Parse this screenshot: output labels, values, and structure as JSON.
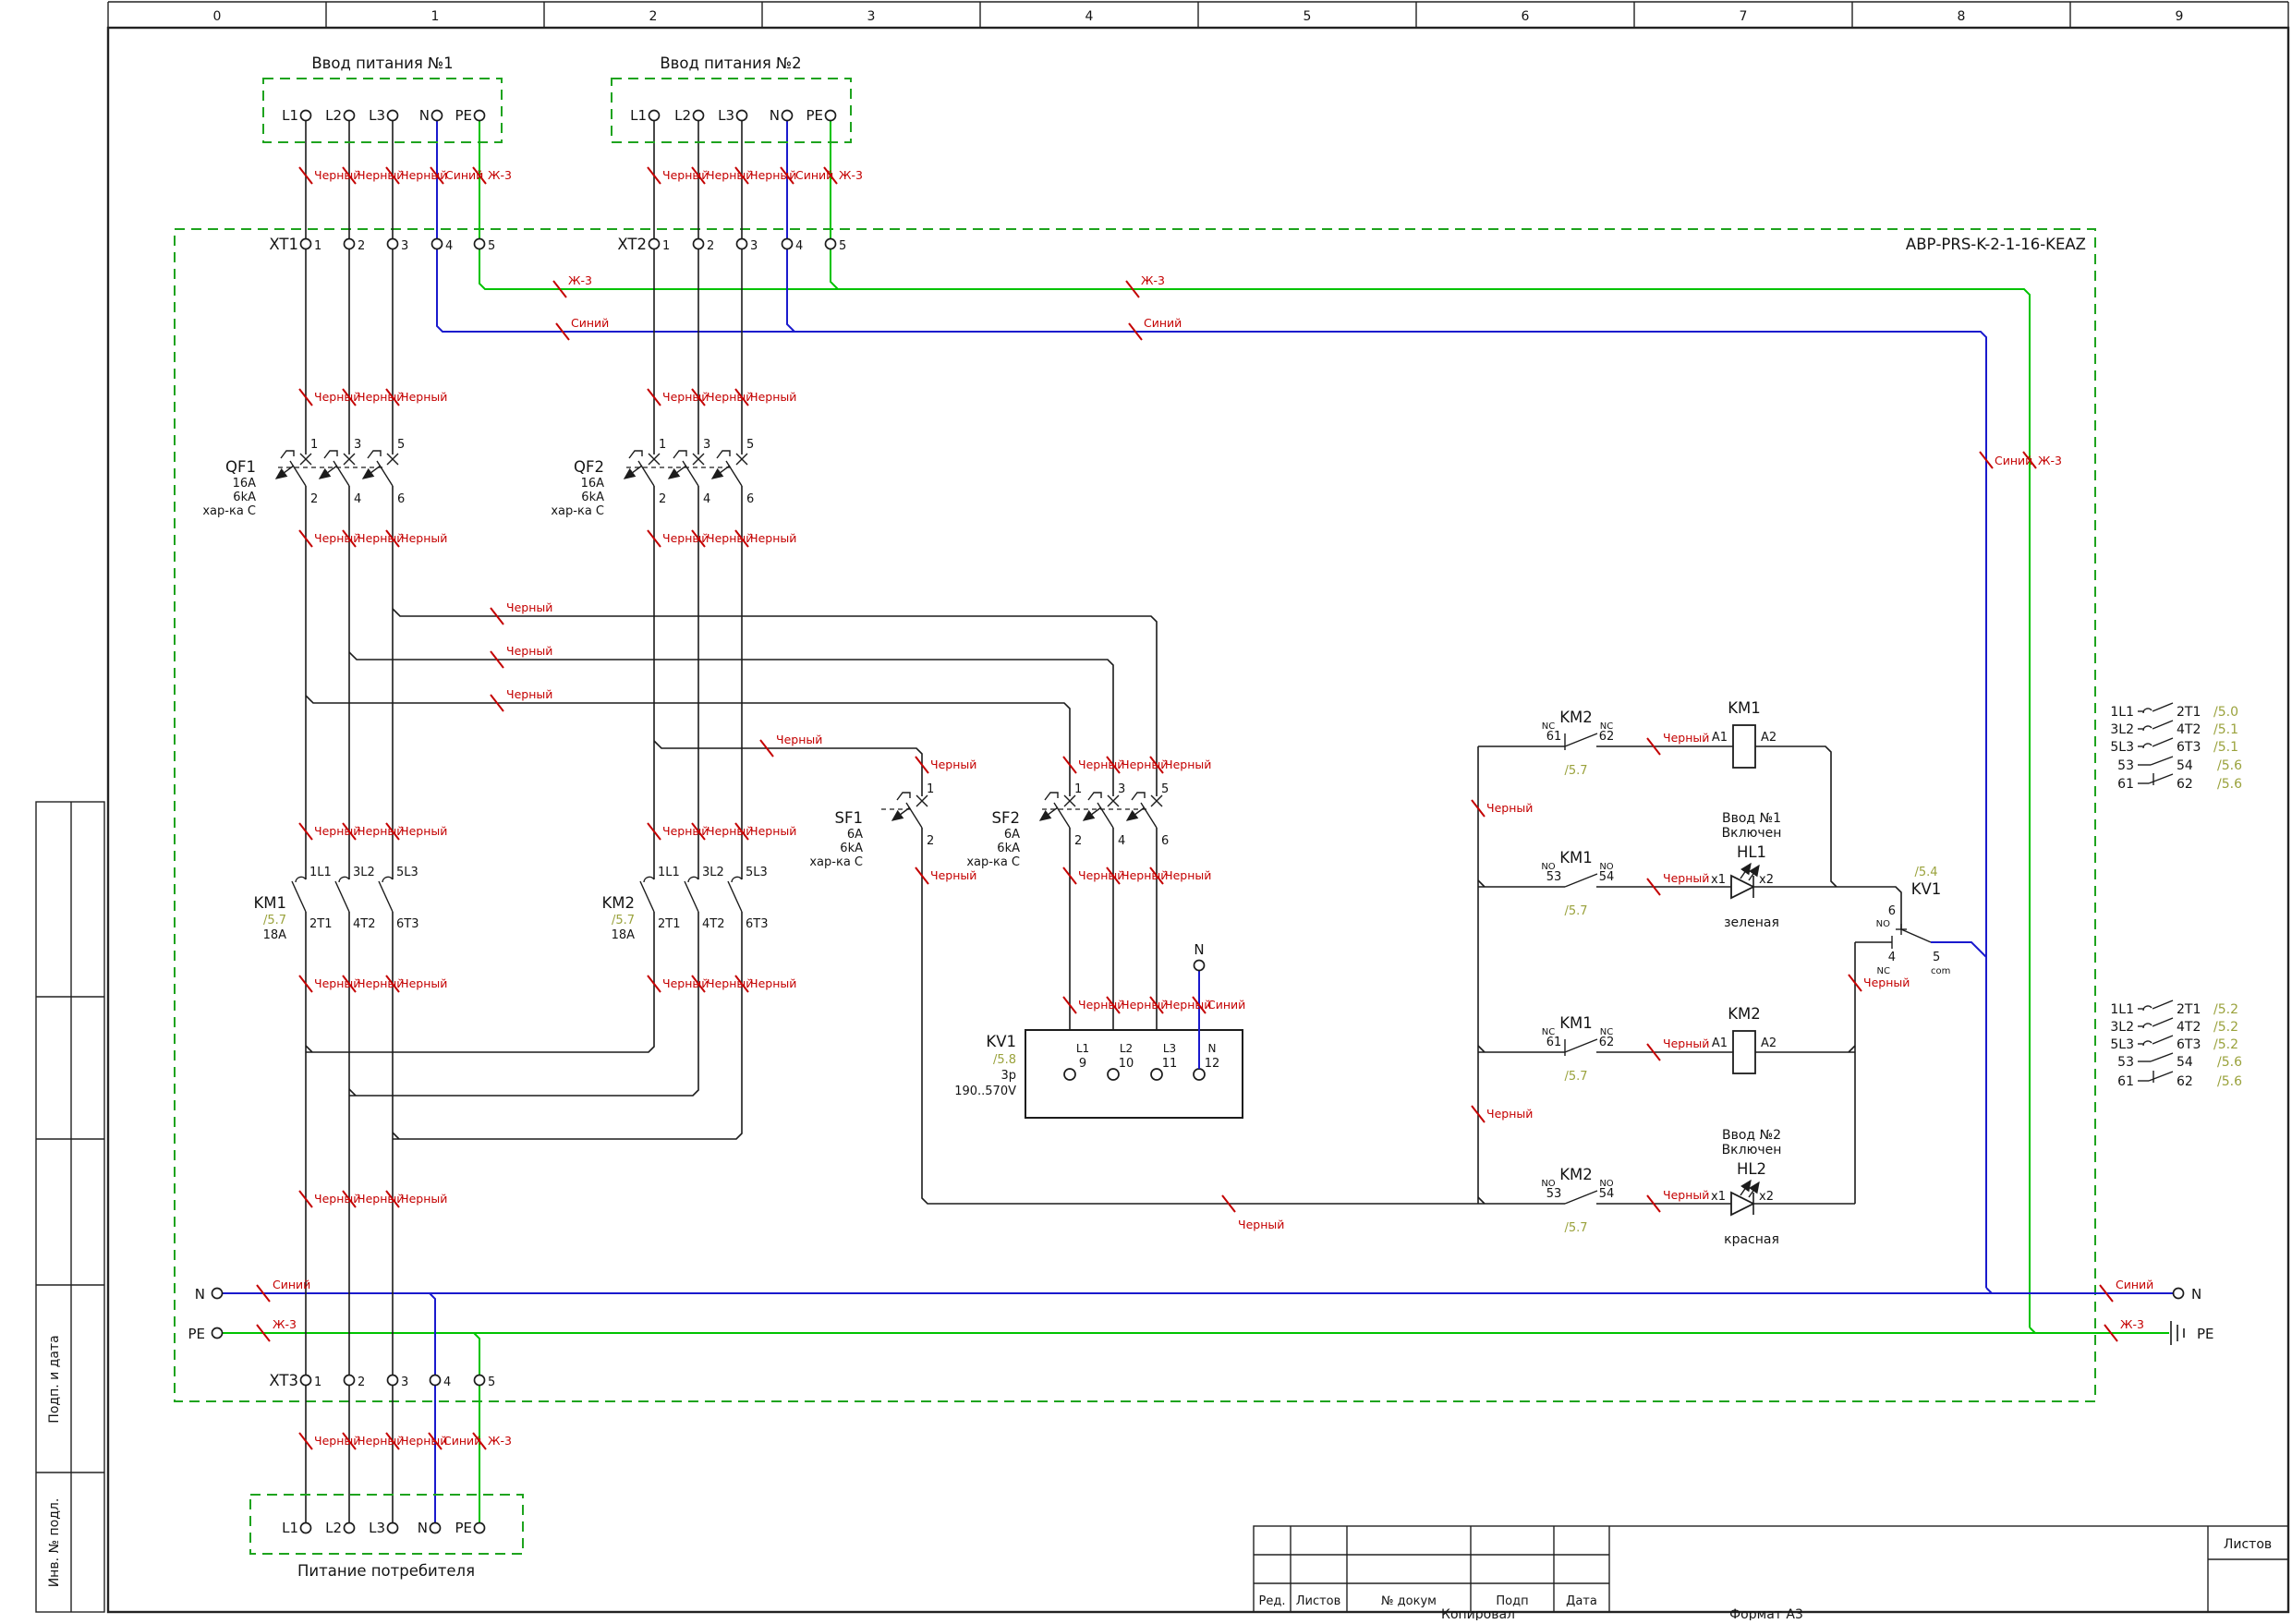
{
  "sheet": {
    "ruler": [
      "0",
      "1",
      "2",
      "3",
      "4",
      "5",
      "6",
      "7",
      "8",
      "9"
    ],
    "side_labels": {
      "sign_date": "Подп. и дата",
      "inv_no": "Инв. № подл."
    },
    "titleblock": {
      "cols": [
        "Ред.",
        "Листов",
        "№ докум",
        "Подп",
        "Дата"
      ],
      "sheets_label": "Листов"
    },
    "footer": {
      "copied": "Копировал",
      "format": "Формат А3"
    }
  },
  "device": {
    "name": "АВР-PRS-K-2-1-16-KEAZ"
  },
  "wire_colors": {
    "black": "Черный",
    "blue": "Синий",
    "yellow_green": "Ж-3"
  },
  "feeds": {
    "input1_title": "Ввод питания №1",
    "input2_title": "Ввод питания №2",
    "consumer_title": "Питание потребителя",
    "terminals": [
      "L1",
      "L2",
      "L3",
      "N",
      "PE"
    ]
  },
  "xt": {
    "xt1": "XT1",
    "xt2": "XT2",
    "xt3": "XT3",
    "numbers": [
      "1",
      "2",
      "3",
      "4",
      "5"
    ]
  },
  "breakers": {
    "qf1": "QF1",
    "qf2": "QF2",
    "qf_specs": [
      "16A",
      "6kA",
      "хар-ка C"
    ],
    "sf1": "SF1",
    "sf2": "SF2",
    "sf_specs": [
      "6A",
      "6kA",
      "хар-ка C"
    ],
    "pole_top": [
      "1",
      "3",
      "5"
    ],
    "pole_bottom": [
      "2",
      "4",
      "6"
    ]
  },
  "contactors": {
    "km1": "KM1",
    "km2": "KM2",
    "ref": "/5.7",
    "amps": "18A",
    "main_top": [
      "1L1",
      "3L2",
      "5L3"
    ],
    "main_bottom": [
      "2T1",
      "4T2",
      "6T3"
    ],
    "coil_a1": "A1",
    "coil_a2": "A2",
    "aux_nc": {
      "a": "61",
      "b": "62",
      "t": "NC"
    },
    "aux_no": {
      "a": "53",
      "b": "54",
      "t": "NO"
    }
  },
  "kv1": {
    "name": "KV1",
    "box_ref": "/5.8",
    "poles": "3p",
    "range": "190..570V",
    "terms": [
      {
        "t": "L1",
        "n": "9"
      },
      {
        "t": "L2",
        "n": "10"
      },
      {
        "t": "L3",
        "n": "11"
      },
      {
        "t": "N",
        "n": "12"
      }
    ],
    "contact": {
      "ref": "/5.4",
      "no_n": "6",
      "no_t": "NO",
      "nc_n": "4",
      "nc_t": "NC",
      "com_n": "5",
      "com_t": "com"
    }
  },
  "neutral_label": "N",
  "lamps": {
    "hl1": {
      "name": "HL1",
      "cap1": "Ввод №1",
      "cap2": "Включен",
      "color": "зеленая",
      "x1": "x1",
      "x2": "x2"
    },
    "hl2": {
      "name": "HL2",
      "cap1": "Ввод №2",
      "cap2": "Включен",
      "color": "красная",
      "x1": "x1",
      "x2": "x2"
    }
  },
  "xref": {
    "km1_rows": [
      {
        "a": "1L1",
        "b": "2T1",
        "r": "/5.0"
      },
      {
        "a": "3L2",
        "b": "4T2",
        "r": "/5.1"
      },
      {
        "a": "5L3",
        "b": "6T3",
        "r": "/5.1"
      },
      {
        "a": "53",
        "b": "54",
        "r": "/5.6"
      },
      {
        "a": "61",
        "b": "62",
        "r": "/5.6"
      }
    ],
    "km2_rows": [
      {
        "a": "1L1",
        "b": "2T1",
        "r": "/5.2"
      },
      {
        "a": "3L2",
        "b": "4T2",
        "r": "/5.2"
      },
      {
        "a": "5L3",
        "b": "6T3",
        "r": "/5.2"
      },
      {
        "a": "53",
        "b": "54",
        "r": "/5.6"
      },
      {
        "a": "61",
        "b": "62",
        "r": "/5.6"
      }
    ]
  }
}
